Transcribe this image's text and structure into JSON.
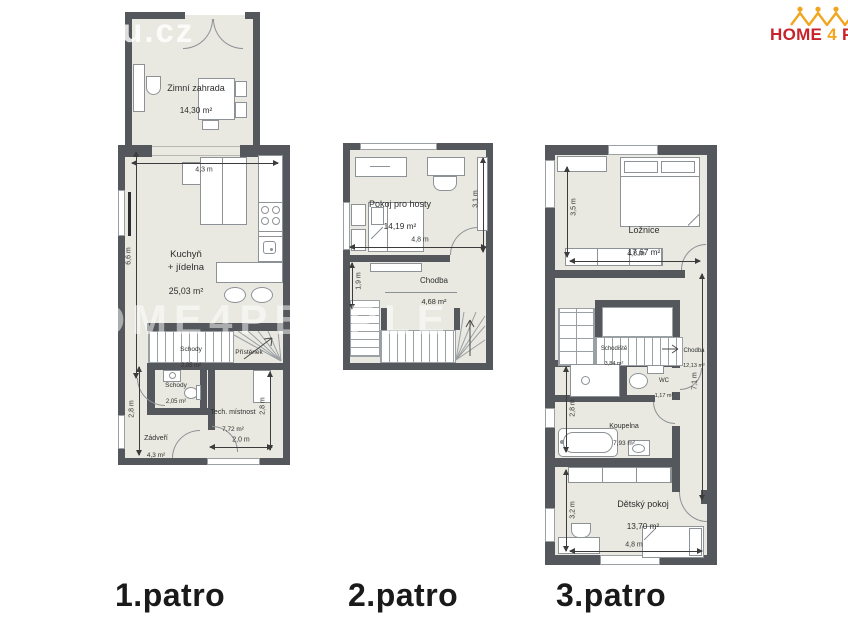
{
  "watermarks": {
    "corner": "itu.cz",
    "center": "HOME4PEOPLE"
  },
  "logo": {
    "home": "HOME",
    "four": "4",
    "people": "PE"
  },
  "colors": {
    "wall": "#54585c",
    "floor": "#e9e9e1",
    "accent_red": "#c8232b",
    "accent_yellow": "#f2a51f"
  },
  "floors": [
    {
      "label": "1.patro",
      "rooms": {
        "zimni": {
          "name": "Zimní zahrada",
          "area": "14,30 m²"
        },
        "kuchyn": {
          "name": "Kuchyň\n+ jídelna",
          "area": "25,03 m²"
        },
        "schody_h": {
          "name": "Schody",
          "area": "2,05 m²"
        },
        "pristenek": {
          "name": "Přístěnek",
          "area": ""
        },
        "schody_d": {
          "name": "Schody",
          "area": "2,05 m²"
        },
        "tech": {
          "name": "Tech. místnost",
          "area": "7,72 m²"
        },
        "zadveri": {
          "name": "Zádveří",
          "area": "4,3 m²"
        }
      },
      "dims": {
        "top": "4,3 m",
        "left": "6,6 m",
        "left2": "2,8 m",
        "right": "2,8 m",
        "bottom": "2,0 m"
      }
    },
    {
      "label": "2.patro",
      "rooms": {
        "hoste": {
          "name": "Pokoj pro hosty",
          "area": "14,19 m²"
        },
        "chodba": {
          "name": "Chodba",
          "area": "4,68 m²"
        }
      },
      "dims": {
        "width": "4,8 m",
        "right": "3,1 m",
        "left": "1,9 m"
      }
    },
    {
      "label": "3.patro",
      "rooms": {
        "loznice": {
          "name": "Ložnice",
          "area": "17,67 m²"
        },
        "schodiste": {
          "name": "Schodiště",
          "area": "3,84 m²"
        },
        "chodba": {
          "name": "Chodba",
          "area": "12,13 m²"
        },
        "wc": {
          "name": "WC",
          "area": "1,17 m²"
        },
        "koupelna": {
          "name": "Koupelna",
          "area": "7,93 m²"
        },
        "detsky": {
          "name": "Dětský pokoj",
          "area": "13,70 m²"
        }
      },
      "dims": {
        "loz_left": "3,5 m",
        "loz_w": "4,8 m",
        "right": "7,1 m",
        "koup": "2,8 m",
        "det": "3,2 m",
        "det_w": "4,8 m"
      }
    }
  ]
}
